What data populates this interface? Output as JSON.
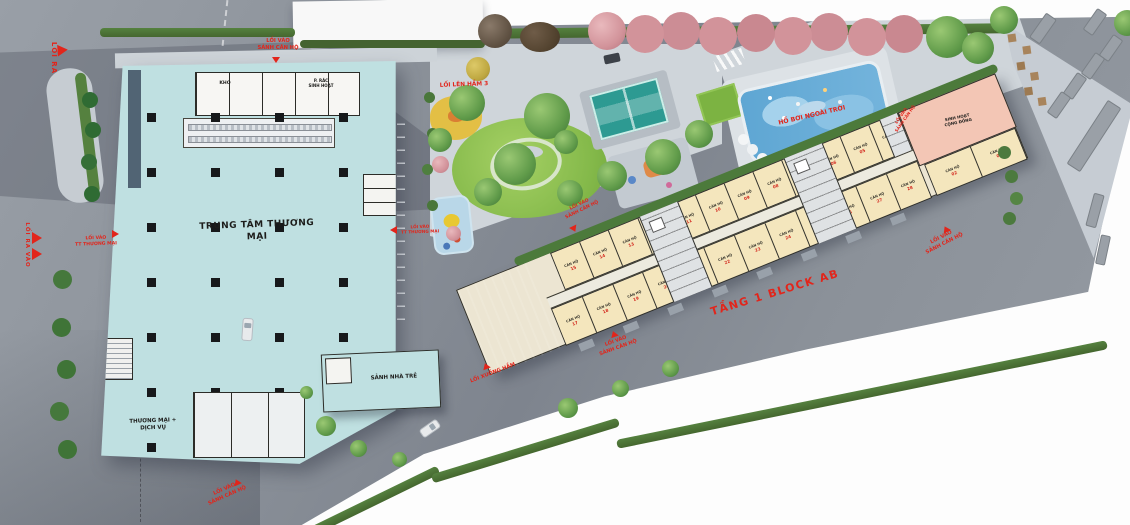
{
  "colors": {
    "label_red": "#e2251b",
    "mall_teal": "#bfe0e1",
    "unit_cream": "#f4e6bd",
    "community_pink": "#f3c6b5",
    "pool_blue": "#64a8d2",
    "lawn_green": "#8bc34a",
    "road_gray": "#8d939b",
    "hedge_green": "#4a7339"
  },
  "mall": {
    "title": "TRUNG TÂM THƯƠNG MẠI",
    "room_storage": "KHO",
    "room_waste": "P. RÁC\nSINH HOẠT",
    "zone_commerce_service": "THƯƠNG MẠI +\nDỊCH VỤ",
    "zone_kindergarten_lobby": "SẢNH NHÀ TRẺ"
  },
  "amenities": {
    "outdoor_pool": "HỒ BƠI NGOÀI TRỜI",
    "community_room": "SINH HOẠT\nCỘNG ĐỒNG"
  },
  "block": {
    "floor_label": "TẦNG 1 BLOCK AB",
    "unit_label": "CĂN HỘ",
    "upper_unit_numbers": [
      "15",
      "14",
      "13",
      "12",
      "11",
      "10",
      "09",
      "08",
      "07",
      "06",
      "05",
      "04"
    ],
    "lower_unit_numbers": [
      "17",
      "18",
      "19",
      "20",
      "21",
      "22",
      "23",
      "24",
      "25",
      "26",
      "27",
      "28"
    ],
    "right_unit_numbers": [
      "02",
      "03"
    ]
  },
  "entrances": {
    "exit": "LỐI RA",
    "exit_entry": "LỐI RA VÀO",
    "mall_entry": "LỐI VÀO\nTT THƯƠNG MẠI",
    "lobby_entry": "LỐI VÀO\nSẢNH CĂN HỘ",
    "ramp_up_basement": "LỐI LÊN HẦM 3",
    "ramp_down_basement": "LỐI XUỐNG HẦM"
  }
}
